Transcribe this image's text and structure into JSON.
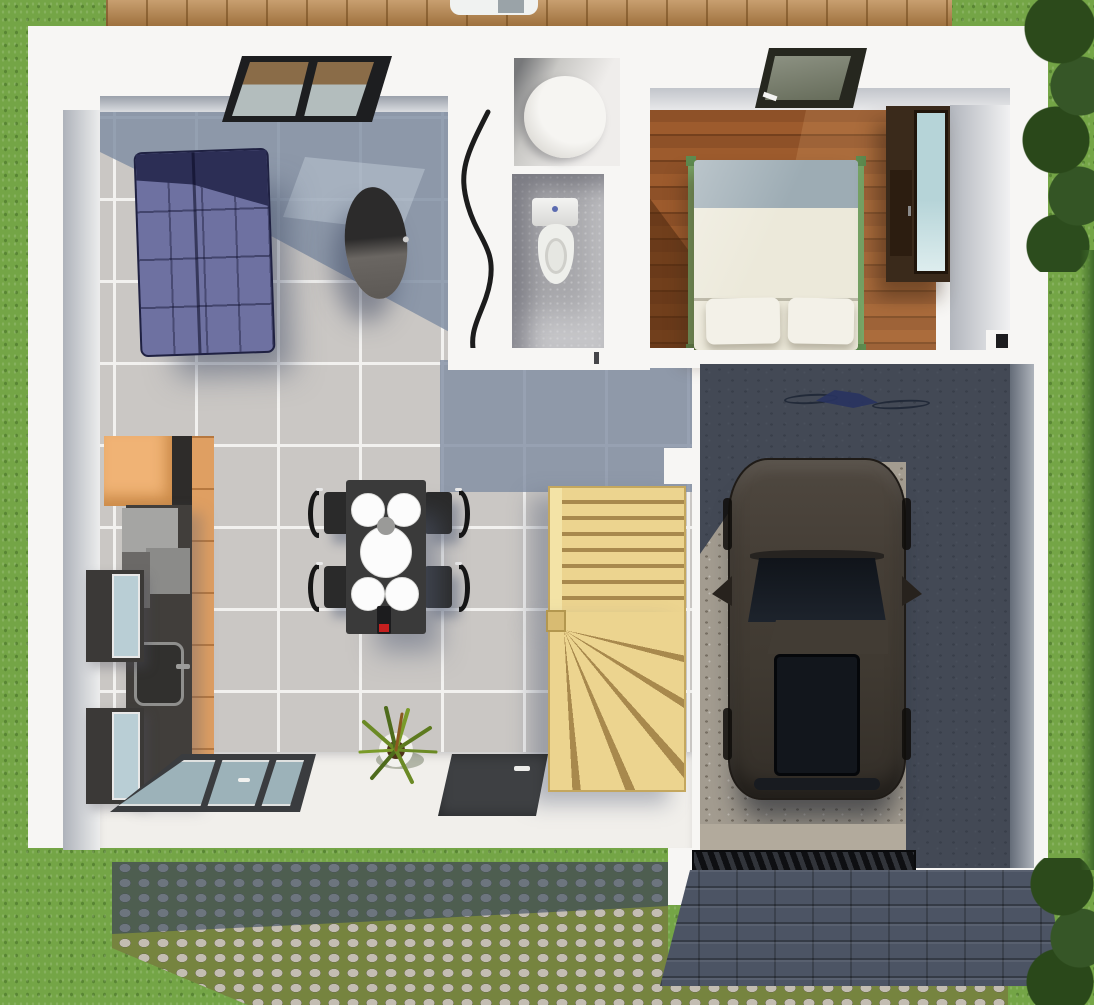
{
  "scene": {
    "title": "3D floor plan render — single-storey house with garage, top-down view",
    "view": "top-down 3d architectural render, no visible text",
    "palette": {
      "grass": "#74a546",
      "grass_dark": "#57882f",
      "tree": "#2e4c1c",
      "deck": "#bc8a50",
      "wall": "#f7f6f4",
      "wall_face": "#c9ccd2",
      "tile": "#cac7c4",
      "tile_shadow": "#7f8da3",
      "grout": "#f2f1ef",
      "wood_floor": "#8a4d25",
      "sofa_dark": "#2c2e55",
      "sofa_light": "#6e71a1",
      "coffee_table": "#33312f",
      "cabinet": "#df9f62",
      "counter": "#413e3b",
      "appliance_glass": "#b9ced5",
      "dining_table": "#3a3a3a",
      "plate": "#fcfcfc",
      "chair": "#161616",
      "stair_wood": "#ecd48f",
      "stair_line": "#a8894d",
      "concrete": "#a39c90",
      "garage_shadow": "rgba(40,50,68,0.78)",
      "car_body": "#453e36",
      "car_glass": "#12161c",
      "roof": "#4c5464",
      "cobble_moss": "#76843f",
      "cobble_stone": "#c3bdb2",
      "cobble_shadow": "rgba(52,68,92,0.6)",
      "bike": "#2b36c4",
      "bed_linen": "#ece9da",
      "bed_head": "#9dacb4",
      "bed_frame": "#78a667",
      "wardrobe": "#3a2a1b",
      "toilet": "#eeefeb",
      "entry_floor": "#f1efeb",
      "door_dark": "#3a3c3f",
      "door_glass": "#9cb2b9"
    },
    "rooms": [
      {
        "name": "living-room",
        "floor": "grey ceramic tile",
        "items": [
          "navy corner sofa",
          "dark oval coffee table",
          "glazed skylight in ceiling"
        ]
      },
      {
        "name": "kitchen",
        "items": [
          "orange wood cabinets",
          "dark counter with sink and faucet",
          "two wall ovens with glass fronts",
          "grey appliance blocks"
        ]
      },
      {
        "name": "dining-area",
        "items": [
          "dark rectangular table",
          "4 black chairs",
          "4 small plates",
          "1 large centre plate",
          "small bowl",
          "wine bottle with red label"
        ]
      },
      {
        "name": "shower-room",
        "items": [
          "round shower tray"
        ]
      },
      {
        "name": "wc",
        "items": [
          "toilet with tank"
        ],
        "detail": "curved white partition wall on living-room side"
      },
      {
        "name": "bedroom",
        "floor": "hardwood planks",
        "items": [
          "double bed with 2 pillows and green frame",
          "wardrobe with glass doors",
          "skylight in ceiling"
        ]
      },
      {
        "name": "stair-hall",
        "items": [
          "pine winder staircase, 8 straight treads + 5 winder treads"
        ]
      },
      {
        "name": "garage",
        "floor": "concrete",
        "items": [
          "dark grey car with sunroof",
          "blue bicycle lying on floor",
          "entrance drainage grate"
        ]
      },
      {
        "name": "entrance",
        "items": [
          "glazed door panel",
          "dark front-door mat with handle",
          "potted plant"
        ]
      }
    ],
    "exterior": [
      "lawn on all sides",
      "dense trees top-right and bottom-right",
      "wooden deck strip along top",
      "cobblestone driveway with moss joints at bottom",
      "slate porch roof below garage"
    ],
    "counts": {
      "dining_chairs": 4,
      "plates_small": 4,
      "plates_large": 1,
      "pillows": 2,
      "skylights": 2
    }
  }
}
